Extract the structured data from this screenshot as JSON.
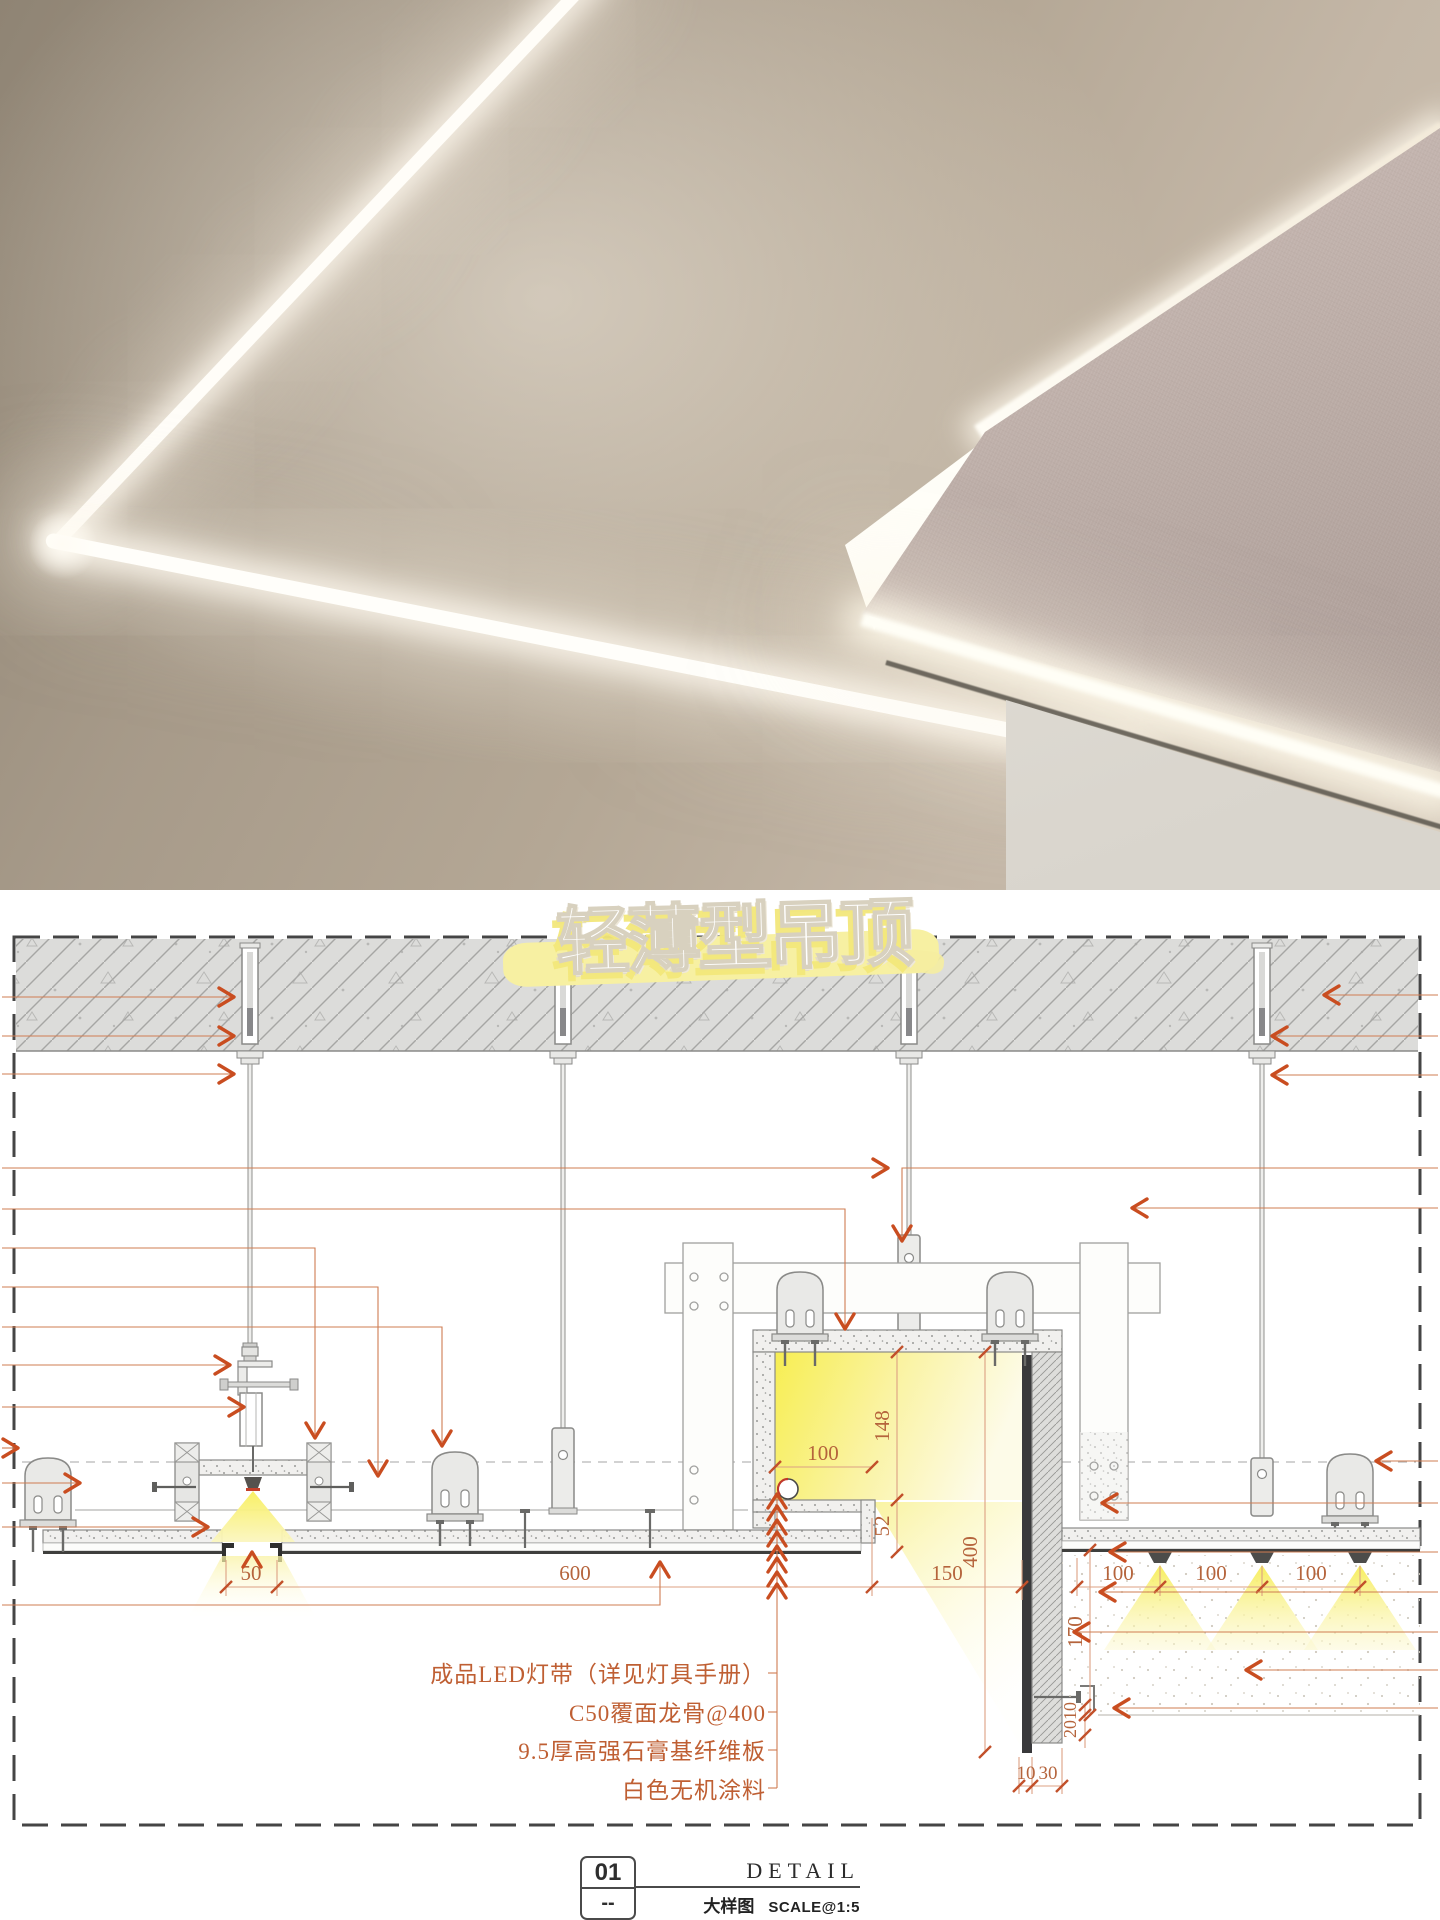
{
  "page": {
    "title_badge": "轻薄型吊顶"
  },
  "drawing": {
    "dims": {
      "slot_width": "50",
      "board_span": "600",
      "cove_ledge": "100",
      "cove_height": "148",
      "cove_step": "52",
      "drop_total": "400",
      "cove_width": "150",
      "spot_gap_1": "100",
      "spot_gap_2": "100",
      "spot_gap_3": "100",
      "side_drop": "170",
      "edge_a": "10",
      "edge_b": "20",
      "edge_c": "10",
      "edge_d": "30"
    },
    "callouts": [
      "成品LED灯带（详见灯具手册）",
      "C50覆面龙骨@400",
      "9.5厚高强石膏基纤维板",
      "白色无机涂料"
    ]
  },
  "title_block": {
    "number": "01",
    "revision": "--",
    "name_en": "DETAIL",
    "name_cn": "大样图",
    "scale": "SCALE@1:5"
  },
  "colors": {
    "leader": "#cf7c52",
    "arrow": "#c94d20",
    "dim_text": "#b5643c",
    "glow_yellow": "#f7ee55",
    "brush_yellow": "#f6efa0",
    "slab_fill": "#dcdcda"
  }
}
